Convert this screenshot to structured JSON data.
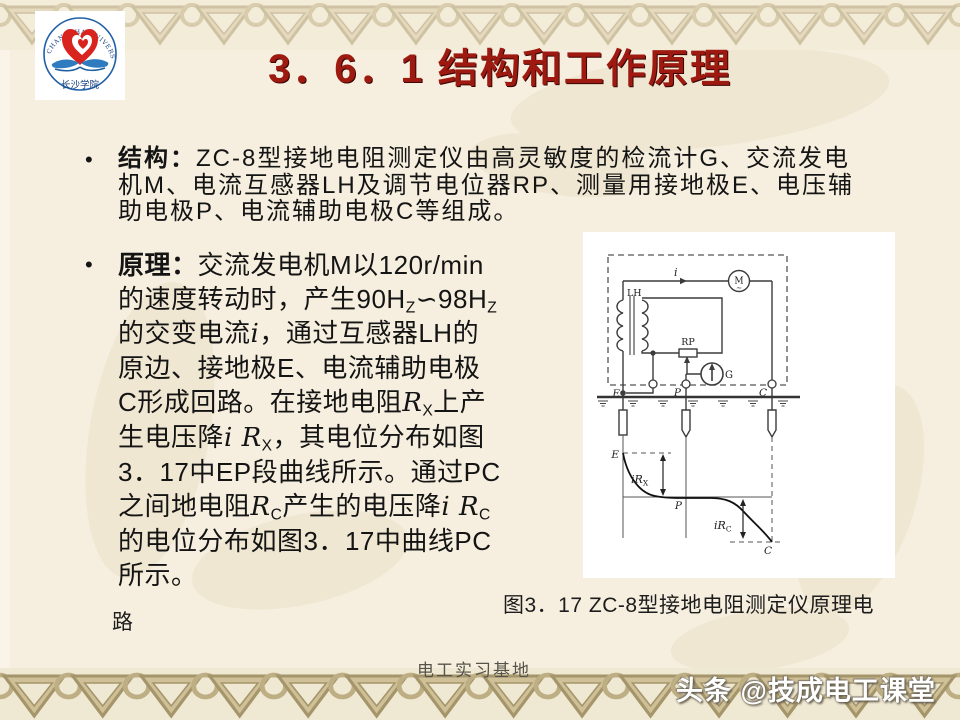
{
  "title": "3．6．1 结构和工作原理",
  "logo": {
    "arc_text": "CHANGSHA UNIVERSITY",
    "cn_text": "长沙学院"
  },
  "bullets": {
    "b1_marker": "•",
    "b2_marker": "•",
    "b1_lines": [
      "<b>结构：</b>ZC-8型接地电阻测定仪由高灵敏度的检流计G、交流发电",
      "机M、电流互感器LH及调节电位器RP、测量用接地极E、电压辅",
      "助电极P、电流辅助电极C等组成。"
    ],
    "b2_lines": [
      "<b>原理：</b>交流发电机M以120r/min",
      "的速度转动时，产生90H<sub>Z</sub>∽98H<sub>Z</sub>",
      "的交变电流<i>i</i>，通过互感器LH的",
      "原边、接地极E、电流辅助电极",
      "C形成回路。在接地电阻<i>R</i><sub>X</sub>上产",
      "生电压降<i>i R</i><sub>X</sub>，其电位分布如图",
      "3．17中EP段曲线所示。通过PC",
      "之间地电阻<i>R</i><sub>C</sub>产生的电压降<i>i R</i><sub>C</sub>",
      "的电位分布如图3．17中曲线PC",
      "所示。"
    ]
  },
  "figure": {
    "caption": "图3．17  ZC-8型接地电阻测定仪原理电",
    "caption_wrap": "路",
    "labels": {
      "lh": "LH",
      "i": "i",
      "m": "M",
      "m_tilde": "∼",
      "rp": "RP",
      "g": "G",
      "e_terminal": "E",
      "p_terminal": "P",
      "c_terminal": "C",
      "e_curve": "E",
      "p_curve": "P",
      "c_curve": "C",
      "ir_x_main": "iR",
      "ir_x_sub": "X",
      "ir_c_main": "iR",
      "ir_c_sub": "C"
    }
  },
  "footer": "电工实习基地",
  "watermark": "头条 @技成电工课堂",
  "colors": {
    "title_red": "#9e1a10",
    "logo_heart_red": "#d8231f",
    "logo_wing_blue": "#2e7bc0",
    "border_tan": "#cdbc92",
    "background_cream": "#f6efdf"
  }
}
